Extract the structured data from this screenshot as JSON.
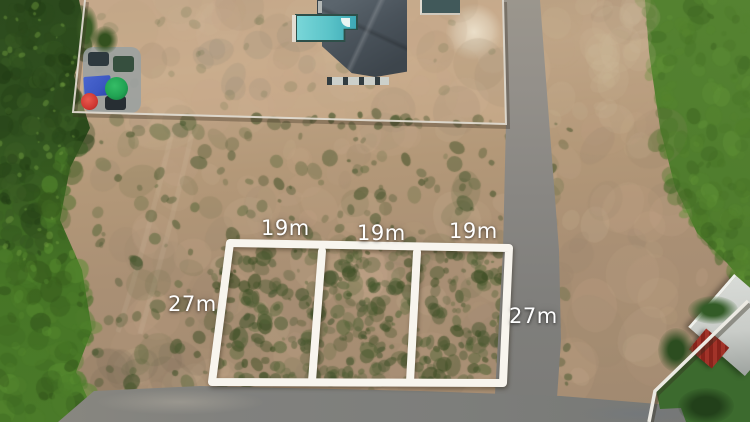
{
  "meta": {
    "description": "Aerial drone photo of vacant subdivided land: three marked plots outlined in white on cleared dirt, house with swimming pool at top, roads, and green fields at the edges"
  },
  "annotations": {
    "widths": [
      {
        "text": "19m"
      },
      {
        "text": "19m"
      },
      {
        "text": "19m"
      }
    ],
    "depths": [
      {
        "text": "27m"
      },
      {
        "text": "27m"
      }
    ]
  },
  "colors": {
    "dirt_base": "#b29878",
    "dirt_light": "#cdb698",
    "dirt_dark": "#93806a",
    "grass_left_dark": "#2c4a1d",
    "grass_left_bright": "#4a7a29",
    "grass_right": "#507e33",
    "lawn_neighbor": "#3c6a2e",
    "road": "#82827f",
    "road_light": "#98948c",
    "plot_outline": "#f8f5ee",
    "label_text": "#ffffff",
    "roof_main": "#4a535b",
    "roof_flat": "#b4b8b6",
    "roof_outbuilding": "#41595a",
    "roof_neighbor_light": "#c9ccc8",
    "roof_neighbor_red": "#9e2f28",
    "pool_water": "#5ac3c8",
    "pool_border": "#2e4f49",
    "fence": "#ded9cf",
    "tarp_blue": "#3c58c2",
    "umbrella_green": "#21a353",
    "umbrella_red": "#cf3832",
    "vehicle_dark": "#2e393e"
  }
}
